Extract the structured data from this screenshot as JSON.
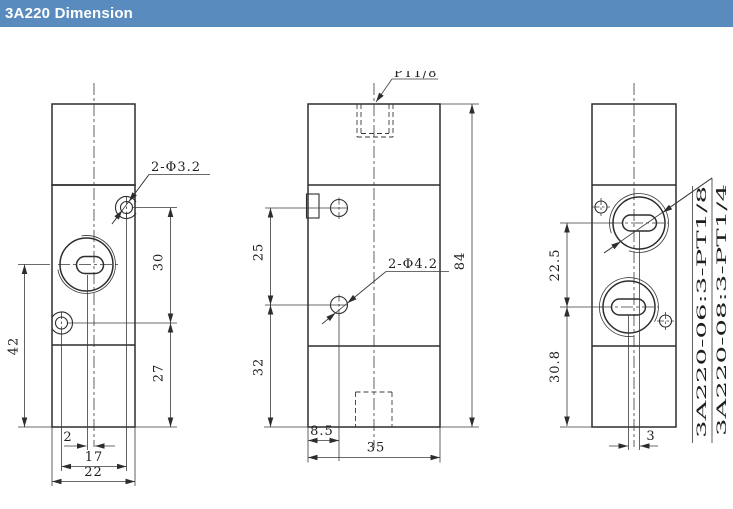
{
  "header": {
    "title": "3A220 Dimension"
  },
  "colors": {
    "header_bg": "#5a8bbe",
    "header_text": "#ffffff",
    "line": "#2d2d2d",
    "background": "#ffffff"
  },
  "views": {
    "left": {
      "callout": "2-Φ3.2",
      "dims": {
        "port_center_height": "42",
        "hole_vertical_spacing": "30",
        "bottom_section_height": "27",
        "slot_offset": "2",
        "hole_horizontal_spacing": "17",
        "body_width": "22"
      }
    },
    "center": {
      "port_thread": "PT1/8",
      "callout": "2-Φ4.2",
      "dims": {
        "hole_spacing": "25",
        "lower_hole_height": "32",
        "body_height": "84",
        "hole_edge_offset": "8.5",
        "body_depth": "35"
      }
    },
    "right": {
      "models": [
        "3A220-06:3-PT1/8",
        "3A220-08:3-PT1/4"
      ],
      "dims": {
        "port_spacing": "22.5",
        "lower_port_height": "30.8",
        "slot_offset": "3"
      }
    }
  }
}
